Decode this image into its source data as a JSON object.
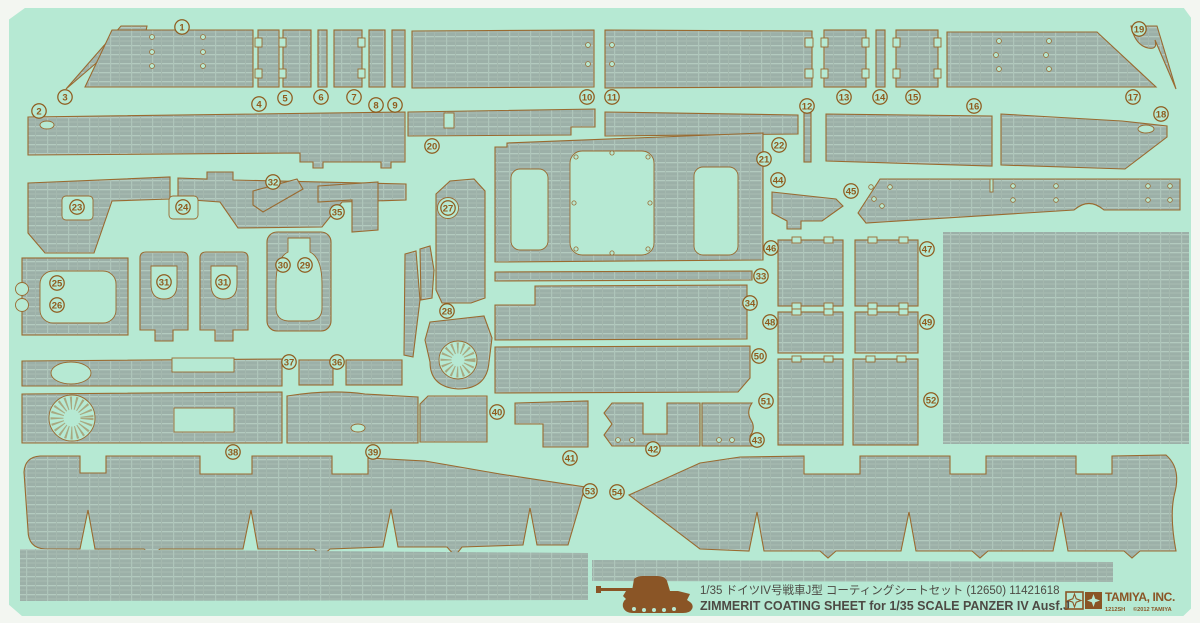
{
  "sheet": {
    "name": "zimmerit-coating-sheet-scan",
    "colors": {
      "scan_white": "#f3f6f1",
      "sheet_green": "#b6e9d3",
      "zimmerit_base": "#9cb0a8",
      "zimmerit_light": "#b3cabf",
      "outline_brown": "#9a6a30",
      "label_brown": "#8f5c1e",
      "footer_text": "#4d4a44",
      "log o_brown_note": "",
      "logo_brown": "#8a5526"
    }
  },
  "footer": {
    "title_jp": "1/35 ドイツIV号戦車J型 コーティングシートセット (12650) 11421618",
    "title_en": "ZIMMERIT COATING SHEET for 1/35 SCALE PANZER IV Ausf.J",
    "brand": "TAMIYA, INC.",
    "sheet_code": "1212SH",
    "copyright": "©2012 TAMIYA",
    "tank_icon": "panzer-iv-silhouette"
  },
  "part_labels": [
    {
      "n": "1",
      "x": 182,
      "y": 27
    },
    {
      "n": "2",
      "x": 39,
      "y": 111
    },
    {
      "n": "3",
      "x": 65,
      "y": 97
    },
    {
      "n": "4",
      "x": 259,
      "y": 104
    },
    {
      "n": "5",
      "x": 285,
      "y": 98
    },
    {
      "n": "6",
      "x": 321,
      "y": 97
    },
    {
      "n": "7",
      "x": 354,
      "y": 97
    },
    {
      "n": "8",
      "x": 376,
      "y": 105
    },
    {
      "n": "9",
      "x": 395,
      "y": 105
    },
    {
      "n": "10",
      "x": 587,
      "y": 97
    },
    {
      "n": "11",
      "x": 612,
      "y": 97
    },
    {
      "n": "12",
      "x": 807,
      "y": 106
    },
    {
      "n": "13",
      "x": 844,
      "y": 97
    },
    {
      "n": "14",
      "x": 880,
      "y": 97
    },
    {
      "n": "15",
      "x": 913,
      "y": 97
    },
    {
      "n": "16",
      "x": 974,
      "y": 106
    },
    {
      "n": "17",
      "x": 1133,
      "y": 97
    },
    {
      "n": "18",
      "x": 1161,
      "y": 114
    },
    {
      "n": "19",
      "x": 1139,
      "y": 29
    },
    {
      "n": "20",
      "x": 432,
      "y": 146
    },
    {
      "n": "21",
      "x": 764,
      "y": 159
    },
    {
      "n": "22",
      "x": 779,
      "y": 145
    },
    {
      "n": "23",
      "x": 77,
      "y": 207
    },
    {
      "n": "24",
      "x": 183,
      "y": 207
    },
    {
      "n": "25",
      "x": 57,
      "y": 283
    },
    {
      "n": "26",
      "x": 57,
      "y": 305
    },
    {
      "n": "27",
      "x": 448,
      "y": 208
    },
    {
      "n": "28",
      "x": 447,
      "y": 311
    },
    {
      "n": "29",
      "x": 305,
      "y": 265
    },
    {
      "n": "30",
      "x": 283,
      "y": 265
    },
    {
      "n": "31",
      "x": 164,
      "y": 282
    },
    {
      "n": "31",
      "x": 223,
      "y": 282
    },
    {
      "n": "32",
      "x": 273,
      "y": 182
    },
    {
      "n": "33",
      "x": 761,
      "y": 276
    },
    {
      "n": "34",
      "x": 750,
      "y": 303
    },
    {
      "n": "35",
      "x": 337,
      "y": 212
    },
    {
      "n": "36",
      "x": 337,
      "y": 362
    },
    {
      "n": "37",
      "x": 289,
      "y": 362
    },
    {
      "n": "38",
      "x": 233,
      "y": 452
    },
    {
      "n": "39",
      "x": 373,
      "y": 452
    },
    {
      "n": "40",
      "x": 497,
      "y": 412
    },
    {
      "n": "41",
      "x": 570,
      "y": 458
    },
    {
      "n": "42",
      "x": 653,
      "y": 449
    },
    {
      "n": "43",
      "x": 757,
      "y": 440
    },
    {
      "n": "44",
      "x": 778,
      "y": 180
    },
    {
      "n": "45",
      "x": 851,
      "y": 191
    },
    {
      "n": "46",
      "x": 771,
      "y": 248
    },
    {
      "n": "47",
      "x": 927,
      "y": 249
    },
    {
      "n": "48",
      "x": 770,
      "y": 322
    },
    {
      "n": "49",
      "x": 927,
      "y": 322
    },
    {
      "n": "50",
      "x": 759,
      "y": 356
    },
    {
      "n": "51",
      "x": 766,
      "y": 401
    },
    {
      "n": "52",
      "x": 931,
      "y": 400
    },
    {
      "n": "53",
      "x": 590,
      "y": 491
    },
    {
      "n": "54",
      "x": 617,
      "y": 492
    }
  ]
}
